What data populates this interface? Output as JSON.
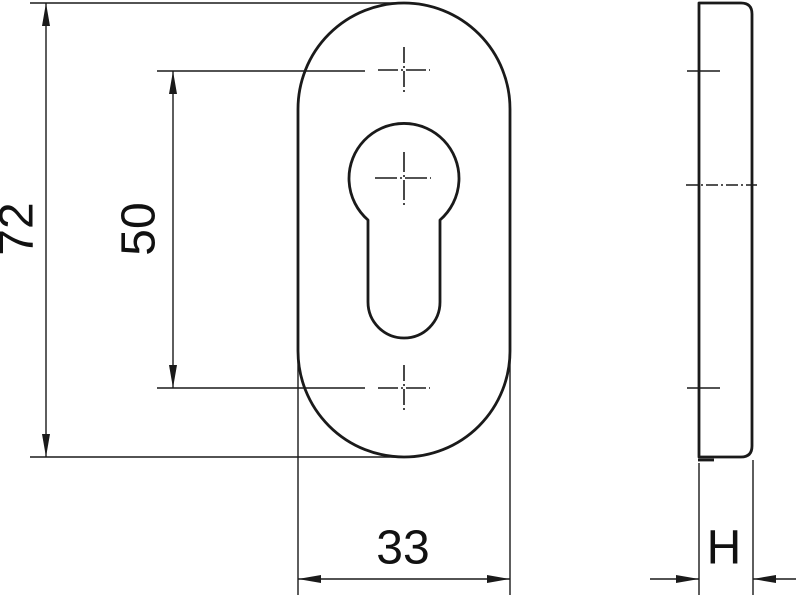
{
  "drawing": {
    "background_color": "#ffffff",
    "line_color": "#1a1a1a",
    "labels": {
      "overall_height": "72",
      "hole_spacing": "50",
      "plate_width": "33",
      "plate_thickness": "H"
    }
  }
}
